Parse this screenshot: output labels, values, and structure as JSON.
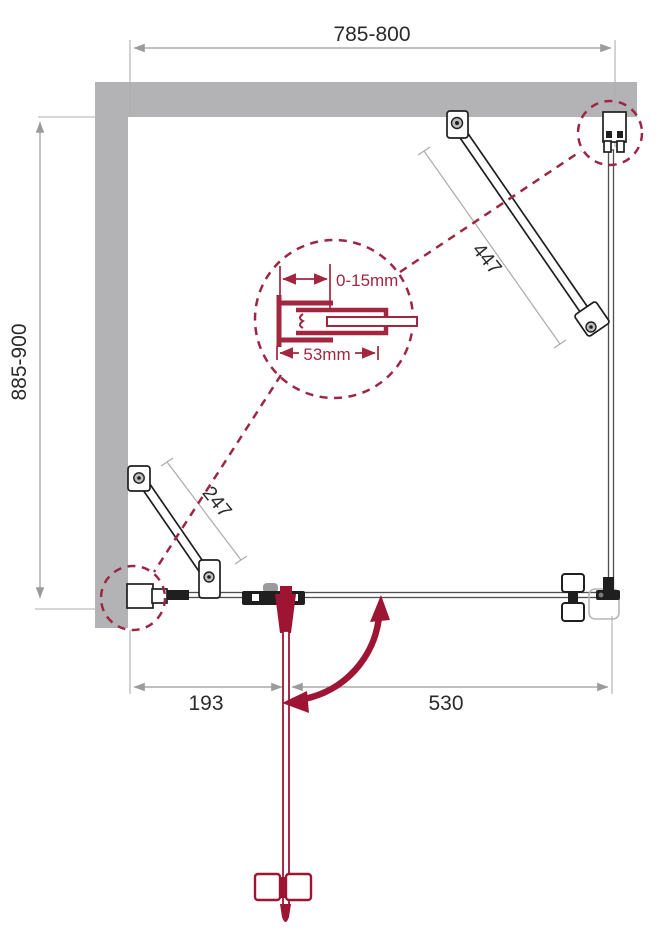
{
  "drawing": {
    "type": "shower-enclosure-installation-diagram",
    "dimensions": {
      "top_width": "785-800",
      "left_height": "885-900",
      "bottom_left_segment": "193",
      "bottom_right_segment": "530",
      "diagonal_bar_right": "447",
      "diagonal_bar_left": "247"
    },
    "detail_callout": {
      "adjustment_range": "0-15mm",
      "profile_width": "53mm"
    },
    "colors": {
      "wall_gray": "#b3b3b5",
      "dimension_gray": "#9b9b9b",
      "text_dark": "#2b2b2b",
      "accent_red": "#9e1433",
      "detail_red": "#a32640",
      "dashed_red": "#9c2744",
      "hardware_dark": "#1f1f1f"
    }
  }
}
